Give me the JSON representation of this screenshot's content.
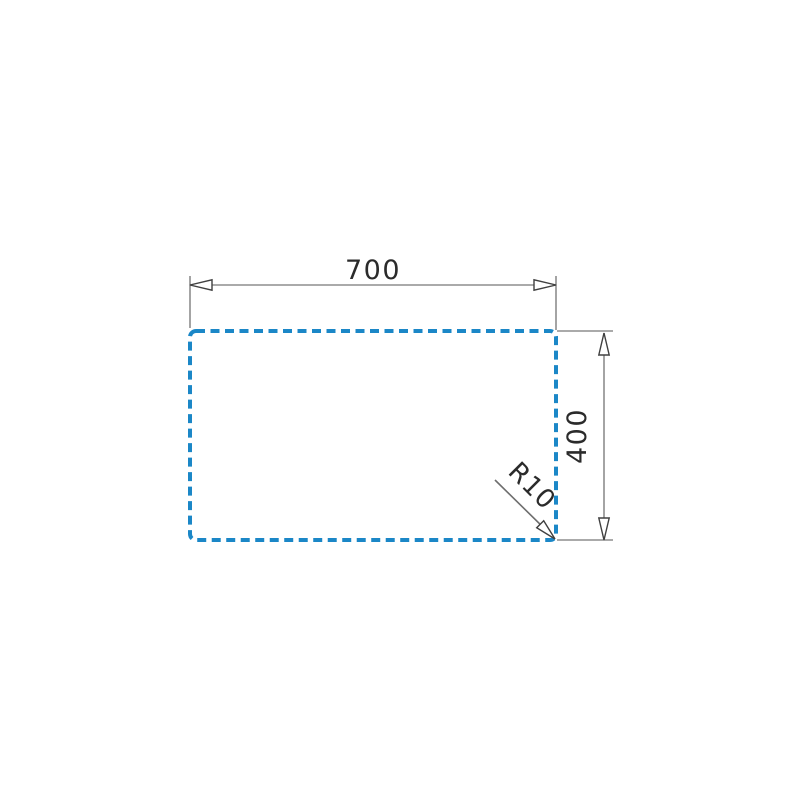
{
  "canvas": {
    "background_color": "#ffffff"
  },
  "diagram": {
    "kind": "technical-dimension-drawing",
    "outline": {
      "description": "dashed cutout outline rectangle",
      "stroke_style": "dashed",
      "color": "#1b87c7"
    },
    "colors": {
      "dimension_line": "#8e8e8e",
      "leader_line": "#6e6e6e",
      "arrow_outline": "#404040",
      "text": "#2b2b2b"
    },
    "dimensions": {
      "width": {
        "label": "700",
        "value": 700
      },
      "height": {
        "label": "400",
        "value": 400
      },
      "corner_radius": {
        "label": "R10",
        "value": 10
      }
    }
  }
}
